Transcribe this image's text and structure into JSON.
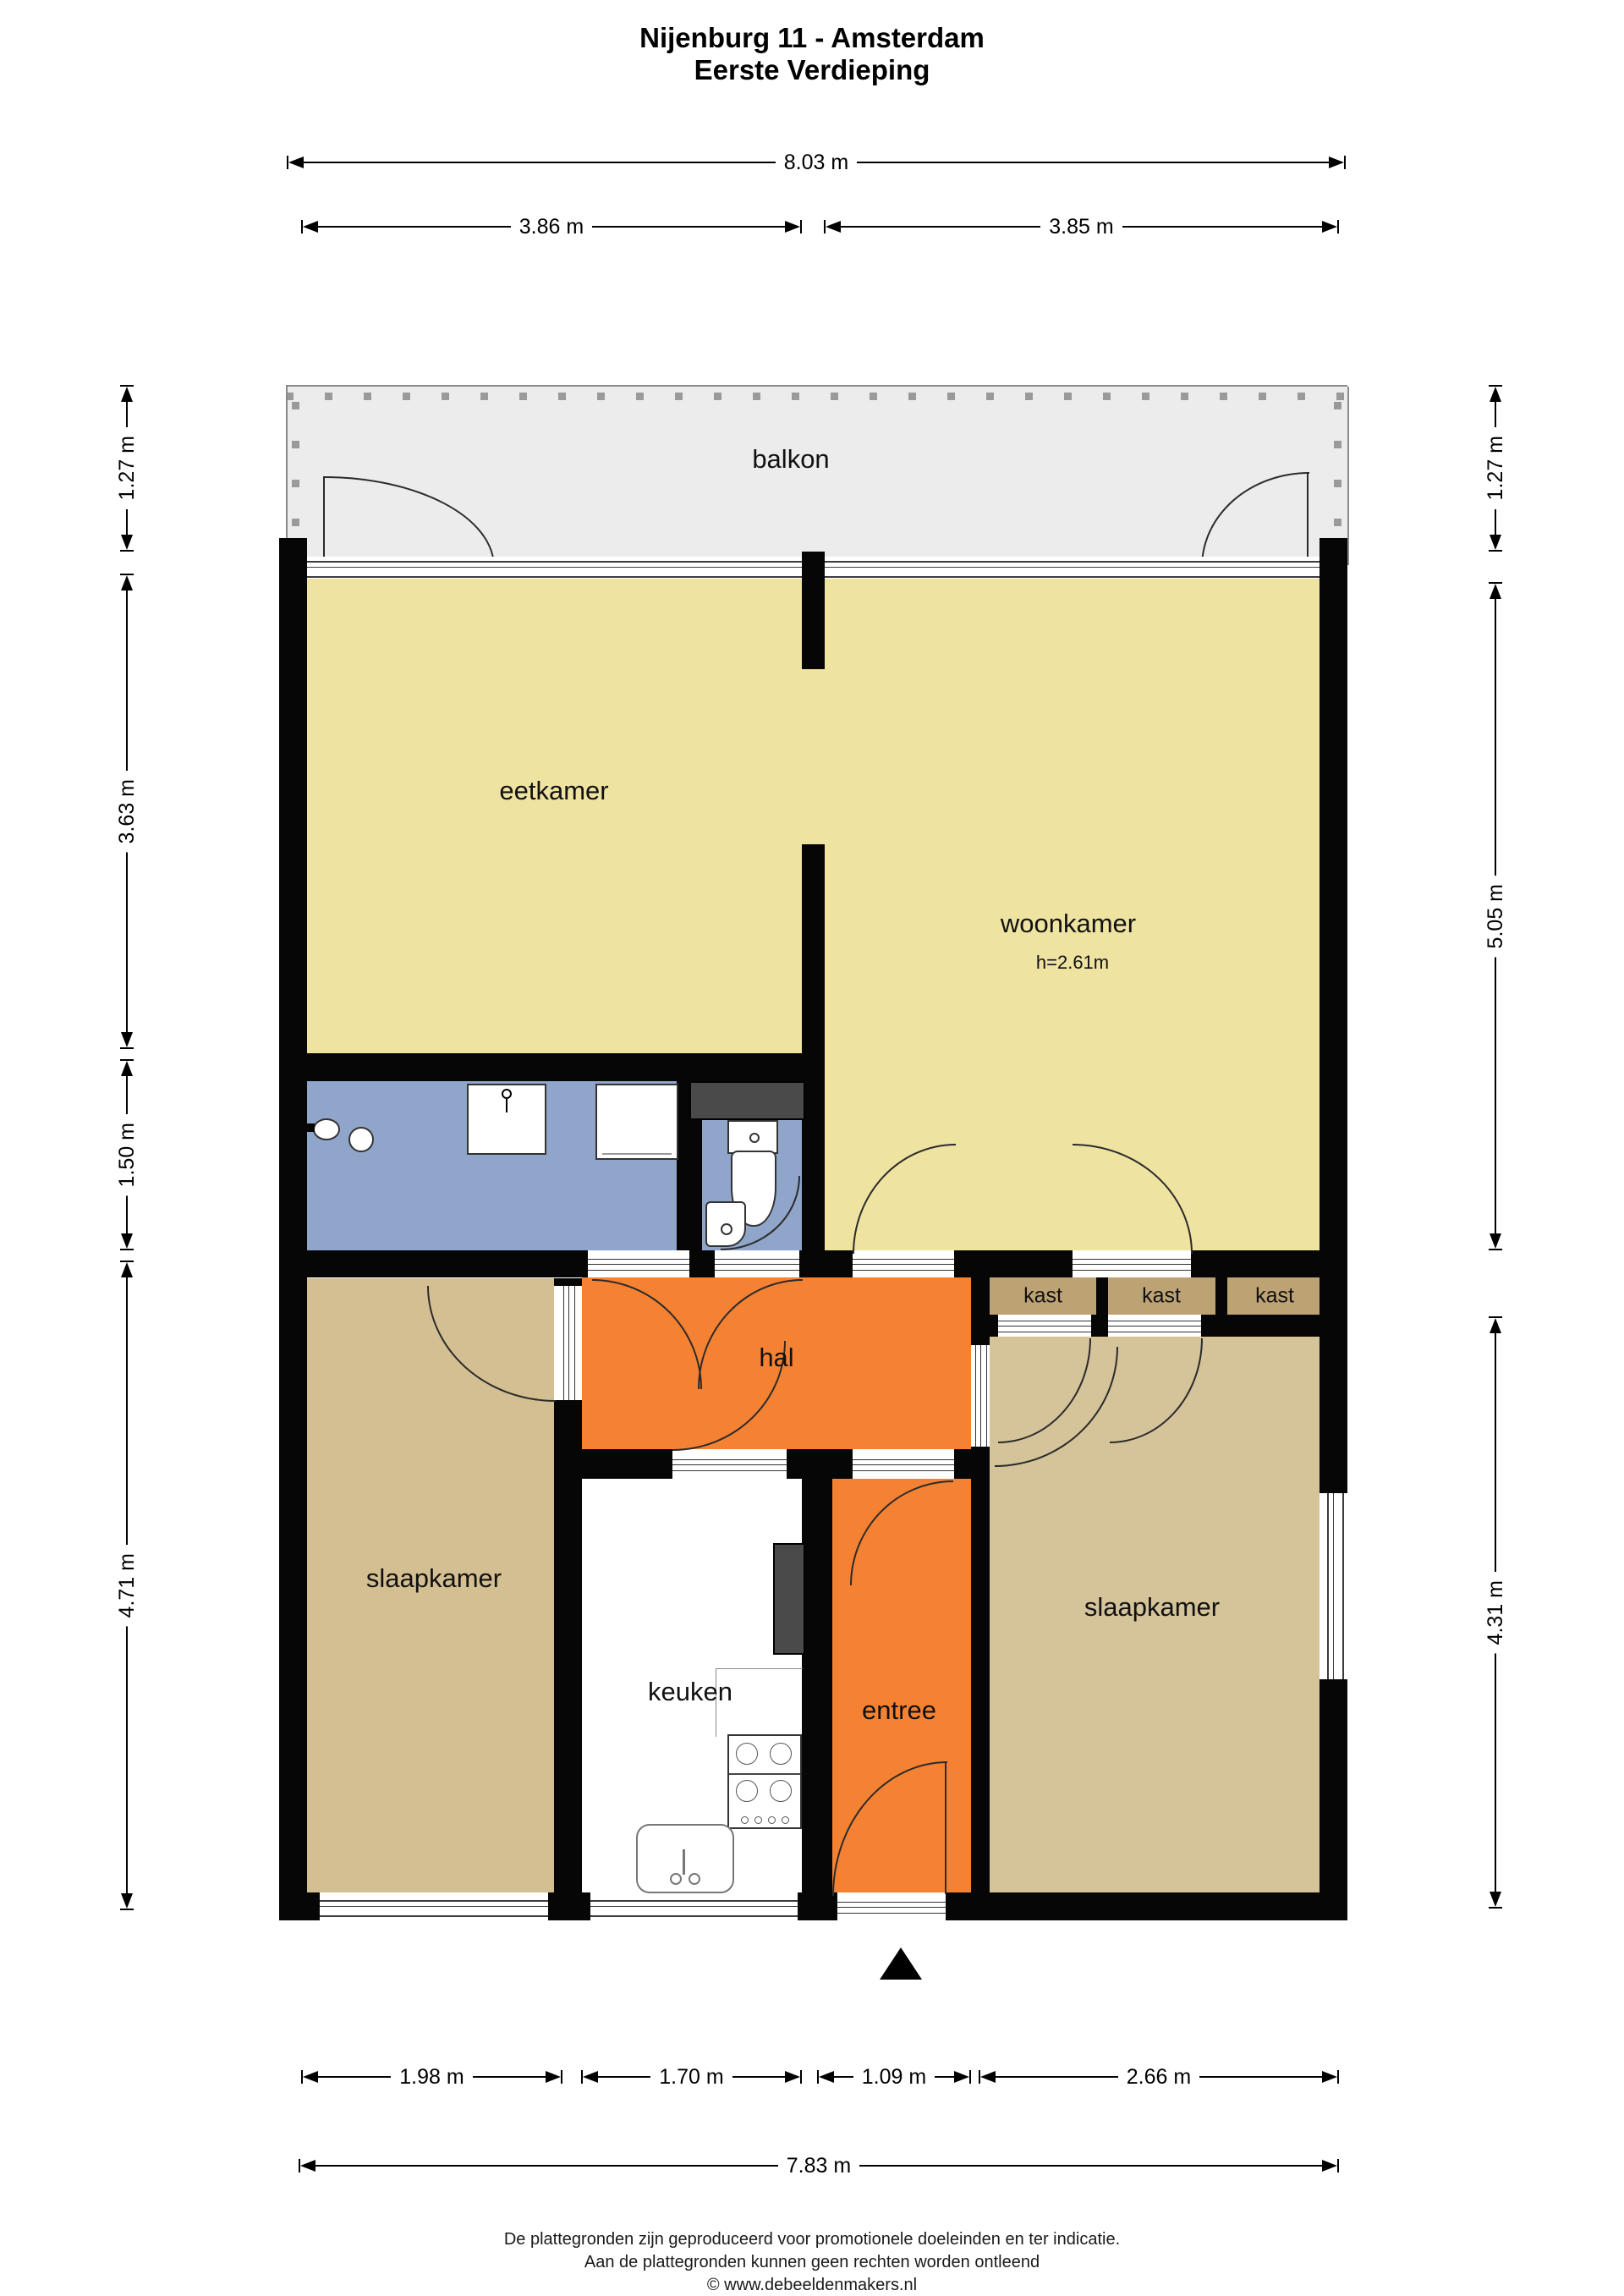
{
  "title": {
    "line1": "Nijenburg 11 - Amsterdam",
    "line2": "Eerste Verdieping"
  },
  "rooms": {
    "balkon": {
      "label": "balkon"
    },
    "eetkamer": {
      "label": "eetkamer"
    },
    "woonkamer": {
      "label": "woonkamer",
      "ceiling_height": "h=2.61m"
    },
    "hal": {
      "label": "hal"
    },
    "kast1": {
      "label": "kast"
    },
    "kast2": {
      "label": "kast"
    },
    "kast3": {
      "label": "kast"
    },
    "slaapkamer_links": {
      "label": "slaapkamer"
    },
    "slaapkamer_rechts": {
      "label": "slaapkamer"
    },
    "keuken": {
      "label": "keuken"
    },
    "entree": {
      "label": "entree"
    }
  },
  "dimensions": {
    "top_total": "8.03 m",
    "top_left": "3.86 m",
    "top_right": "3.85 m",
    "left_balkon": "1.27 m",
    "left_eetkamer": "3.63 m",
    "left_badkamer": "1.50 m",
    "left_slaapkamer": "4.71 m",
    "right_balkon": "1.27 m",
    "right_woonkamer": "5.05 m",
    "right_slaapkamer": "4.31 m",
    "bottom_1": "1.98 m",
    "bottom_2": "1.70 m",
    "bottom_3": "1.09 m",
    "bottom_4": "2.66 m",
    "bottom_total": "7.83 m"
  },
  "footer": {
    "line1": "De plattegronden zijn geproduceerd voor promotionele doeleinden en ter indicatie.",
    "line2": "Aan de plattegronden kunnen geen rechten worden ontleend",
    "line3": "© www.debeeldenmakers.nl"
  },
  "palette": {
    "living": "#efe3a2",
    "bathroom": "#8fa5c9",
    "hall_orange": "#f58233",
    "bedroom_left": "#d3bf92",
    "bedroom_right": "#d5c39a",
    "closet": "#bda274",
    "balcony": "#ececec",
    "wall": "#060606",
    "duct": "#4a4a4a"
  }
}
